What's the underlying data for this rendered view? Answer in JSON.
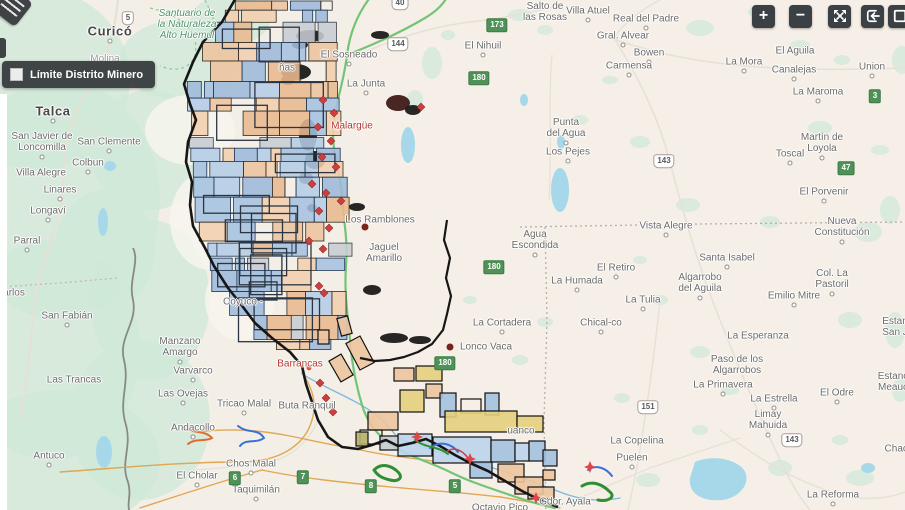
{
  "legend": {
    "label": "Límite Distrito Minero"
  },
  "controls": [
    {
      "name": "zoom-in-button",
      "glyph": "plus",
      "label": "+",
      "x": 752
    },
    {
      "name": "zoom-out-button",
      "glyph": "minus",
      "label": "−",
      "x": 789
    },
    {
      "name": "expand-button",
      "glyph": "arrows-out",
      "label": "",
      "x": 828
    },
    {
      "name": "collapse-extent-button",
      "glyph": "bracket-arrow",
      "label": "",
      "x": 861
    },
    {
      "name": "fullscreen-button",
      "glyph": "square",
      "label": "",
      "x": 888
    }
  ],
  "colors": {
    "button_bg": "#3a4043",
    "legend_bg": "#2f3335",
    "claim_blue": "#a5c1df",
    "claim_blue_light": "#bcd4ec",
    "claim_salmon": "#edc49f",
    "claim_yellow": "#e5cf7c",
    "claim_gray": "#c7ccd3",
    "claim_olive": "#b7b06a",
    "claim_border": "#1d3452",
    "district_border": "#161616",
    "route_green": "#74c476",
    "route_orange": "#dfa042",
    "river_blue": "#6fb1e0",
    "water": "#a6d8ea",
    "terrain_green": "#cfe8d8",
    "land": "#f3efe6",
    "road": "#e6e1d6",
    "marker_red": "#cd3f3f",
    "site_dot": "#7c211c",
    "star_red": "#e04545"
  },
  "map": {
    "labels": [
      {
        "text": "Santuario de\nla Naturaleza\nAlto Huemul",
        "x": 187,
        "y": 25,
        "cls": "park"
      },
      {
        "text": "Curicó",
        "x": 110,
        "y": 32,
        "cls": "city",
        "dot": true
      },
      {
        "text": "Molina",
        "x": 105,
        "y": 59,
        "cls": "faint"
      },
      {
        "text": "Talca",
        "x": 53,
        "y": 112,
        "cls": "city",
        "dot": true
      },
      {
        "text": "San Javier de\nLoncomilla",
        "x": 42,
        "y": 142,
        "cls": "town",
        "dot": true
      },
      {
        "text": "San Clemente",
        "x": 109,
        "y": 142,
        "cls": "town",
        "dot": true
      },
      {
        "text": "Colbun",
        "x": 88,
        "y": 163,
        "cls": "town",
        "dot": true
      },
      {
        "text": "Villa Alegre",
        "x": 41,
        "y": 173,
        "cls": "town"
      },
      {
        "text": "Linares",
        "x": 60,
        "y": 190,
        "cls": "town",
        "dot": true
      },
      {
        "text": "Longaví",
        "x": 48,
        "y": 211,
        "cls": "town",
        "dot": true
      },
      {
        "text": "Parral",
        "x": 27,
        "y": 241,
        "cls": "town",
        "dot": true
      },
      {
        "text": "arlos",
        "x": 14,
        "y": 293,
        "cls": "town"
      },
      {
        "text": "San Fabián",
        "x": 67,
        "y": 316,
        "cls": "town",
        "dot": true
      },
      {
        "text": "Las Trancas",
        "x": 74,
        "y": 380,
        "cls": "town"
      },
      {
        "text": "Antuco",
        "x": 49,
        "y": 456,
        "cls": "town",
        "dot": true
      },
      {
        "text": "Manzano\nAmargo",
        "x": 180,
        "y": 347,
        "cls": "town",
        "dot": true
      },
      {
        "text": "Varvarco",
        "x": 193,
        "y": 371,
        "cls": "town",
        "dot": true
      },
      {
        "text": "Las Ovejas",
        "x": 183,
        "y": 394,
        "cls": "town",
        "dot": true
      },
      {
        "text": "Tricao Malal",
        "x": 244,
        "y": 404,
        "cls": "town",
        "dot": true
      },
      {
        "text": "Andacollo",
        "x": 193,
        "y": 428,
        "cls": "town",
        "dot": true
      },
      {
        "text": "Chos Malal",
        "x": 251,
        "y": 464,
        "cls": "town",
        "dot": true
      },
      {
        "text": "El Cholar",
        "x": 197,
        "y": 476,
        "cls": "town",
        "dot": true
      },
      {
        "text": "Taquimilán",
        "x": 256,
        "y": 490,
        "cls": "town",
        "dot": true
      },
      {
        "text": "Buta Ranquil",
        "x": 307,
        "y": 406,
        "cls": "town"
      },
      {
        "text": "Barrancas",
        "x": 300,
        "y": 364,
        "cls": "red"
      },
      {
        "text": "El Sosneado",
        "x": 349,
        "y": 55,
        "cls": "town",
        "dot": true
      },
      {
        "text": "La Junta",
        "x": 366,
        "y": 84,
        "cls": "town",
        "dot": true
      },
      {
        "text": "ñas",
        "x": 287,
        "y": 68,
        "cls": "town"
      },
      {
        "text": "Malargüe",
        "x": 352,
        "y": 126,
        "cls": "red"
      },
      {
        "text": "Los Ramblones",
        "x": 380,
        "y": 220,
        "cls": "town"
      },
      {
        "text": "Jaguel\nAmarillo",
        "x": 384,
        "y": 253,
        "cls": "town"
      },
      {
        "text": "Coyuco -",
        "x": 243,
        "y": 302,
        "cls": "town"
      },
      {
        "text": "El Nihuil",
        "x": 483,
        "y": 46,
        "cls": "town",
        "dot": true
      },
      {
        "text": "Salto de\nlas Rosas",
        "x": 545,
        "y": 12,
        "cls": "town"
      },
      {
        "text": "Villa Atuel",
        "x": 588,
        "y": 11,
        "cls": "town",
        "dot": true
      },
      {
        "text": "Real del Padre",
        "x": 646,
        "y": 19,
        "cls": "town",
        "dot": true
      },
      {
        "text": "Gral. Alvear",
        "x": 623,
        "y": 36,
        "cls": "town",
        "dot": true
      },
      {
        "text": "Bowen",
        "x": 649,
        "y": 53,
        "cls": "town",
        "dot": true
      },
      {
        "text": "Carmensa",
        "x": 629,
        "y": 66,
        "cls": "town",
        "dot": true
      },
      {
        "text": "La Mora",
        "x": 744,
        "y": 62,
        "cls": "town",
        "dot": true
      },
      {
        "text": "El Aguila",
        "x": 795,
        "y": 51,
        "cls": "town"
      },
      {
        "text": "Canalejas",
        "x": 794,
        "y": 70,
        "cls": "town",
        "dot": true
      },
      {
        "text": "Union",
        "x": 872,
        "y": 67,
        "cls": "town",
        "dot": true
      },
      {
        "text": "La Maroma",
        "x": 818,
        "y": 92,
        "cls": "town",
        "dot": true
      },
      {
        "text": "Punta\ndel Agua",
        "x": 566,
        "y": 128,
        "cls": "town",
        "dot": true
      },
      {
        "text": "Los Pejes",
        "x": 568,
        "y": 152,
        "cls": "town",
        "dot": true
      },
      {
        "text": "Martín de\nLoyola",
        "x": 822,
        "y": 143,
        "cls": "town",
        "dot": true
      },
      {
        "text": "Toscal",
        "x": 790,
        "y": 154,
        "cls": "town",
        "dot": true
      },
      {
        "text": "El Porvenir",
        "x": 824,
        "y": 192,
        "cls": "town",
        "dot": true
      },
      {
        "text": "Nueva\nConstitución",
        "x": 842,
        "y": 227,
        "cls": "town",
        "dot": true
      },
      {
        "text": "Vista Alegre",
        "x": 666,
        "y": 226,
        "cls": "town",
        "dot": true
      },
      {
        "text": "Agua\nEscondida",
        "x": 535,
        "y": 240,
        "cls": "town",
        "dot": true
      },
      {
        "text": "Santa Isabel",
        "x": 727,
        "y": 258,
        "cls": "town",
        "dot": true
      },
      {
        "text": "El Retiro",
        "x": 616,
        "y": 268,
        "cls": "town",
        "dot": true
      },
      {
        "text": "La Humada",
        "x": 577,
        "y": 281,
        "cls": "town",
        "dot": true
      },
      {
        "text": "La Tulia",
        "x": 643,
        "y": 300,
        "cls": "town",
        "dot": true
      },
      {
        "text": "Chical-co",
        "x": 601,
        "y": 323,
        "cls": "town",
        "dot": true
      },
      {
        "text": "La Cortadera",
        "x": 502,
        "y": 323,
        "cls": "town",
        "dot": true
      },
      {
        "text": "Lonco Vaca",
        "x": 486,
        "y": 347,
        "cls": "town"
      },
      {
        "text": "Algarrobo\ndel Aguila",
        "x": 700,
        "y": 283,
        "cls": "town",
        "dot": true
      },
      {
        "text": "Col. La\nPastoril",
        "x": 832,
        "y": 279,
        "cls": "town",
        "dot": true
      },
      {
        "text": "Emilio Mitre",
        "x": 794,
        "y": 296,
        "cls": "town",
        "dot": true
      },
      {
        "text": "La Esperanza",
        "x": 758,
        "y": 336,
        "cls": "town"
      },
      {
        "text": "Paso de los\nAlgarrobos",
        "x": 737,
        "y": 365,
        "cls": "town"
      },
      {
        "text": "La Primavera",
        "x": 723,
        "y": 385,
        "cls": "town",
        "dot": true
      },
      {
        "text": "La Estrella",
        "x": 774,
        "y": 399,
        "cls": "town",
        "dot": true
      },
      {
        "text": "El Odre",
        "x": 837,
        "y": 393,
        "cls": "town",
        "dot": true
      },
      {
        "text": "Limay\nMahuida",
        "x": 768,
        "y": 420,
        "cls": "town",
        "dot": true
      },
      {
        "text": "La Copelina",
        "x": 637,
        "y": 441,
        "cls": "town"
      },
      {
        "text": "Puelen",
        "x": 632,
        "y": 458,
        "cls": "town",
        "dot": true
      },
      {
        "text": "La Reforma",
        "x": 833,
        "y": 495,
        "cls": "town",
        "dot": true
      },
      {
        "text": "Gdor. Ayala",
        "x": 565,
        "y": 502,
        "cls": "town"
      },
      {
        "text": "Octavio Pico",
        "x": 500,
        "y": 508,
        "cls": "town"
      },
      {
        "text": "uanco",
        "x": 521,
        "y": 431,
        "cls": "town"
      },
      {
        "text": "Estan\nSan J",
        "x": 895,
        "y": 327,
        "cls": "town"
      },
      {
        "text": "Estanc\nMeauc",
        "x": 893,
        "y": 382,
        "cls": "town"
      },
      {
        "text": "Chach",
        "x": 899,
        "y": 449,
        "cls": "town"
      }
    ],
    "shields": [
      {
        "text": "5",
        "x": 128,
        "y": 18,
        "variant": "white"
      },
      {
        "text": "40",
        "x": 400,
        "y": 3,
        "variant": "white"
      },
      {
        "text": "144",
        "x": 398,
        "y": 44,
        "variant": "white"
      },
      {
        "text": "143",
        "x": 664,
        "y": 161,
        "variant": "white"
      },
      {
        "text": "151",
        "x": 648,
        "y": 407,
        "variant": "white"
      },
      {
        "text": "143",
        "x": 792,
        "y": 440,
        "variant": "white"
      },
      {
        "text": "173",
        "x": 497,
        "y": 25,
        "variant": "green"
      },
      {
        "text": "180",
        "x": 479,
        "y": 78,
        "variant": "green"
      },
      {
        "text": "180",
        "x": 494,
        "y": 267,
        "variant": "green"
      },
      {
        "text": "180",
        "x": 445,
        "y": 363,
        "variant": "green"
      },
      {
        "text": "47",
        "x": 846,
        "y": 168,
        "variant": "green"
      },
      {
        "text": "3",
        "x": 875,
        "y": 96,
        "variant": "green"
      },
      {
        "text": "6",
        "x": 235,
        "y": 478,
        "variant": "green"
      },
      {
        "text": "7",
        "x": 303,
        "y": 477,
        "variant": "green"
      },
      {
        "text": "8",
        "x": 371,
        "y": 486,
        "variant": "green"
      },
      {
        "text": "5",
        "x": 455,
        "y": 486,
        "variant": "green"
      }
    ],
    "markers": [
      {
        "type": "diamond",
        "x": 323,
        "y": 100
      },
      {
        "type": "diamond",
        "x": 334,
        "y": 113
      },
      {
        "type": "diamond",
        "x": 318,
        "y": 127
      },
      {
        "type": "diamond",
        "x": 331,
        "y": 141
      },
      {
        "type": "diamond",
        "x": 322,
        "y": 157
      },
      {
        "type": "diamond",
        "x": 336,
        "y": 167
      },
      {
        "type": "diamond",
        "x": 312,
        "y": 184
      },
      {
        "type": "diamond",
        "x": 326,
        "y": 193
      },
      {
        "type": "diamond",
        "x": 341,
        "y": 201
      },
      {
        "type": "diamond",
        "x": 319,
        "y": 211
      },
      {
        "type": "diamond",
        "x": 329,
        "y": 228
      },
      {
        "type": "diamond",
        "x": 309,
        "y": 241
      },
      {
        "type": "diamond",
        "x": 323,
        "y": 249
      },
      {
        "type": "diamond",
        "x": 319,
        "y": 286
      },
      {
        "type": "diamond",
        "x": 324,
        "y": 293
      },
      {
        "type": "diamond",
        "x": 320,
        "y": 383
      },
      {
        "type": "diamond",
        "x": 326,
        "y": 398
      },
      {
        "type": "diamond",
        "x": 333,
        "y": 412
      },
      {
        "type": "diamond",
        "x": 421,
        "y": 107
      },
      {
        "type": "site-dot",
        "x": 450,
        "y": 347
      },
      {
        "type": "site-dot",
        "x": 365,
        "y": 227
      },
      {
        "type": "star",
        "x": 417,
        "y": 437
      },
      {
        "type": "star",
        "x": 470,
        "y": 459
      },
      {
        "type": "star",
        "x": 536,
        "y": 498
      },
      {
        "type": "star",
        "x": 590,
        "y": 467
      },
      {
        "type": "red-pin",
        "x": 309,
        "y": 368
      },
      {
        "type": "red-pin",
        "x": 338,
        "y": 127
      }
    ]
  }
}
